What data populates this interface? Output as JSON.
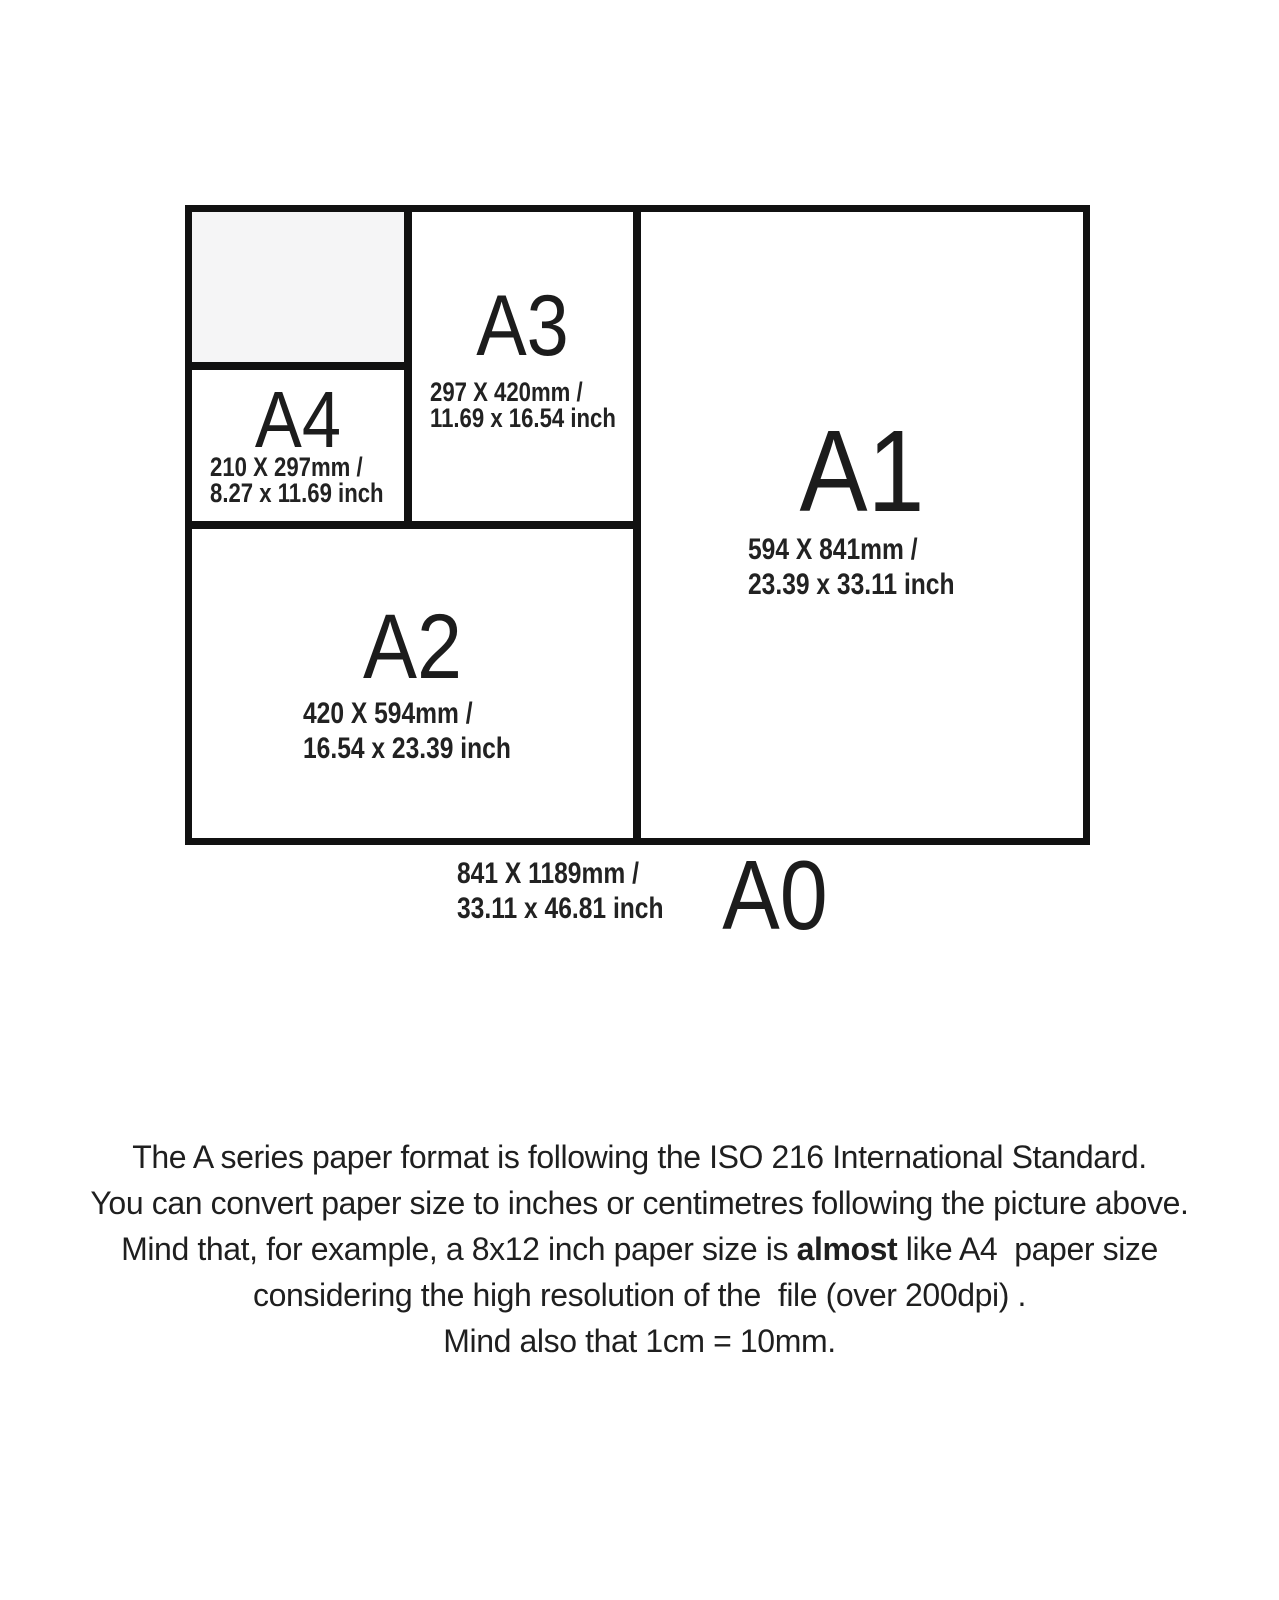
{
  "diagram": {
    "a4": {
      "name": "A4",
      "mm": "210 X 297mm /",
      "inch": "8.27 x 11.69 inch"
    },
    "a3": {
      "name": "A3",
      "mm": "297 X 420mm /",
      "inch": "11.69 x 16.54 inch"
    },
    "a2": {
      "name": "A2",
      "mm": "420 X 594mm /",
      "inch": "16.54 x 23.39 inch"
    },
    "a1": {
      "name": "A1",
      "mm": "594 X 841mm /",
      "inch": "23.39 x 33.11 inch"
    },
    "a0": {
      "name": "A0",
      "mm": "841 X 1189mm /",
      "inch": "33.11 x 46.81 inch"
    }
  },
  "caption": {
    "line1": "The A series paper format is following the ISO 216 International Standard.",
    "line2": "You can convert paper size to inches or centimetres following the picture above.",
    "line3_prefix": "Mind that, for example, a 8x12 inch paper size is ",
    "line3_bold": "almost",
    "line3_suffix": " like A4  paper size",
    "line4": "considering the high resolution of the  file (over 200dpi) .",
    "line5": "Mind also that 1cm = 10mm."
  },
  "colors": {
    "border": "#111111",
    "text": "#1f1f1f",
    "a5_fill": "#f5f5f6"
  }
}
